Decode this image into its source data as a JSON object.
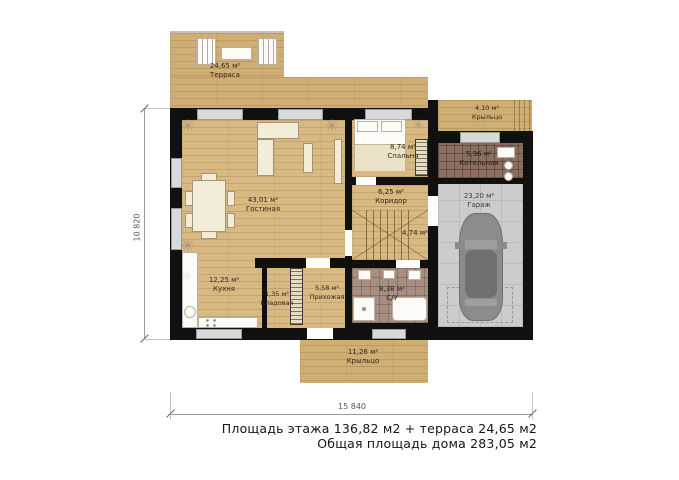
{
  "rooms": {
    "terrace": {
      "area": "24,65 м²",
      "name": "Терраса"
    },
    "living": {
      "area": "43,01 м²",
      "name": "Гостиная"
    },
    "kitchen": {
      "area": "12,25 м²",
      "name": "Кухня"
    },
    "storage": {
      "area": "1,35 м²",
      "name": "Кладовая"
    },
    "hallway": {
      "area": "5,58 м²",
      "name": "Прихожая"
    },
    "bedroom": {
      "area": "8,74 м²",
      "name": "Спальня"
    },
    "corridor": {
      "area": "6,25 м²",
      "name": "Коридор"
    },
    "stairs": {
      "area": "4,74 м²"
    },
    "bathroom": {
      "area": "8,38 м²",
      "name": "С/У"
    },
    "boiler": {
      "area": "5,96 м²",
      "name": "Котельная"
    },
    "garage": {
      "area": "23,20 м²",
      "name": "Гараж"
    },
    "porch_top": {
      "area": "4,10 м²",
      "name": "Крыльцо"
    },
    "porch_bottom": {
      "area": "11,26 м²",
      "name": "Крыльцо"
    }
  },
  "dimensions": {
    "width": "15 840",
    "height": "10 820"
  },
  "summary": {
    "line1": "Площадь этажа 136,82 м2 + терраса 24,65 м2",
    "line2": "Общая площадь дома 283,05 м2"
  },
  "colors": {
    "wood": "#d8b982",
    "wall": "#101010",
    "bath_tile": "#a68e80",
    "boiler_tile": "#8a6e60",
    "garage_floor": "#cccccb",
    "car": "#8b8b8b",
    "window": "#d9d9d9"
  }
}
